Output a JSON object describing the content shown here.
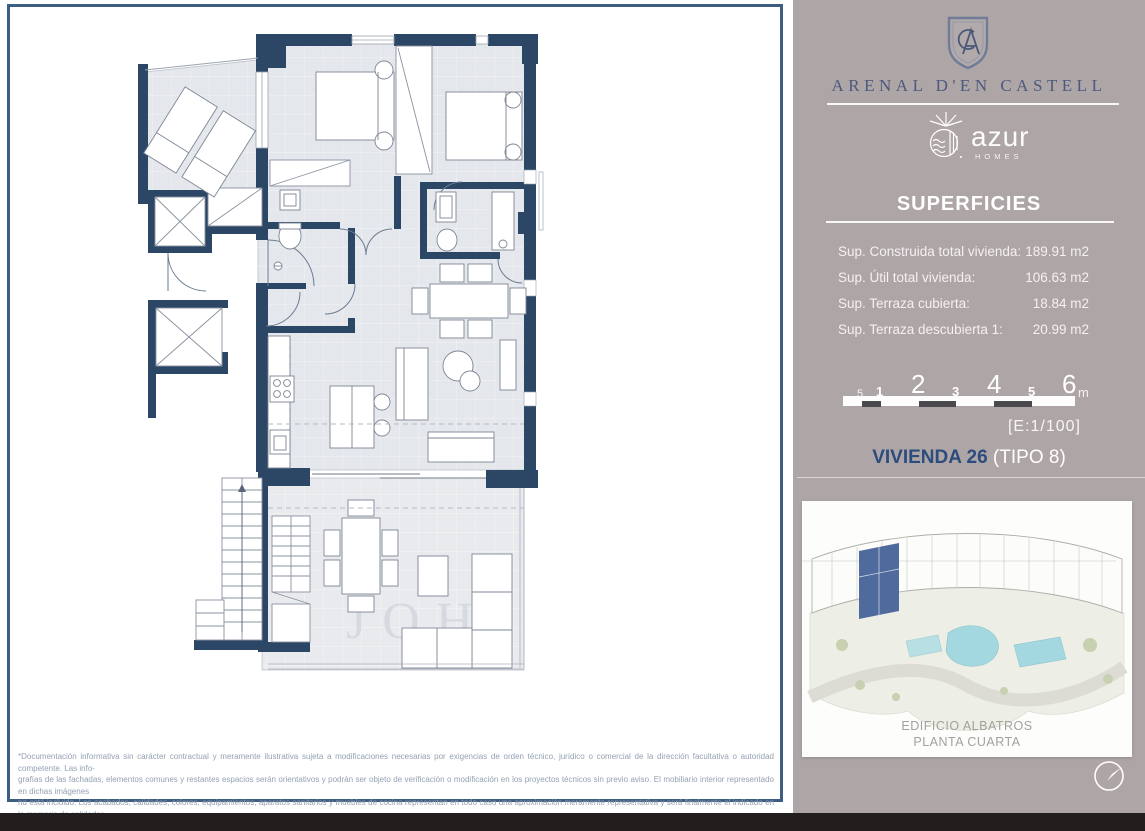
{
  "brand": {
    "monogram": "A",
    "name": "ARENAL D'EN CASTELL",
    "developer": "azur",
    "developer_sub": "HOMES"
  },
  "superficies": {
    "title": "SUPERFICIES",
    "rows": [
      {
        "label": "Sup. Construida total vivienda:",
        "value": "189.91 m2"
      },
      {
        "label": "Sup. Útil total vivienda:",
        "value": "106.63 m2"
      },
      {
        "label": "Sup. Terraza cubierta:",
        "value": "18.84 m2"
      },
      {
        "label": "Sup. Terraza descubierta 1:",
        "value": "20.99 m2"
      }
    ]
  },
  "scalebar": {
    "marks": [
      {
        "label": "5"
      },
      {
        "label": "1"
      },
      {
        "label": "2"
      },
      {
        "label": "3"
      },
      {
        "label": "4"
      },
      {
        "label": "5"
      },
      {
        "label": "6"
      }
    ],
    "unit": "m",
    "ratio": "[E:1/100]"
  },
  "unit": {
    "name": "VIVIENDA 26",
    "type": " (TIPO 8)"
  },
  "siteplan": {
    "caption_line1": "EDIFICIO ALBATROS",
    "caption_line2": "PLANTA CUARTA"
  },
  "floorplan": {
    "watermark": "JOH"
  },
  "legal": {
    "lines": [
      "*Documentación informativa sin carácter contractual y meramente ilustrativa sujeta a modificaciones necesarias por exigencias de orden técnico, jurídico o comercial de la dirección facultativa o autoridad competente. Las info-",
      "grafías de las fachadas, elementos comunes y restantes espacios serán orientativos y podrán ser objeto de verificación o modificación en los proyectos técnicos sin previo aviso. El mobiliario interior representado en dichas imágenes",
      "no está incluido. Los acabados, calidades, colores, equipamientos, aparatos sanitarios y muebles de cocina representan en todo caso una aproximación meramente representativa y será finalmente el indicado en la memoria de calidades",
      "correspondiente. Las certificaciones energéticas se corresponderán con lo establecido finalmente en el proyecto en trámite. Toda la información y entrega de documentación se llevará a cabo conforme lo dispuesto en el Real",
      "Decreto 515/1989 y demás normas que pudieran complementarla ya sean de carácter estatal o autonómico."
    ]
  },
  "colors": {
    "sidebar_bg": "#aea5a6",
    "wall_navy": "#2c4765",
    "frame_border": "#3d5d82",
    "brand_text": "#4d5a7d",
    "unit_title_navy": "#2d4c7e",
    "floor_fill": "#e4e7ec",
    "highlight_unit": "#4f6b9e",
    "pool": "#a4d8e0",
    "black_bar": "#221e1d"
  }
}
